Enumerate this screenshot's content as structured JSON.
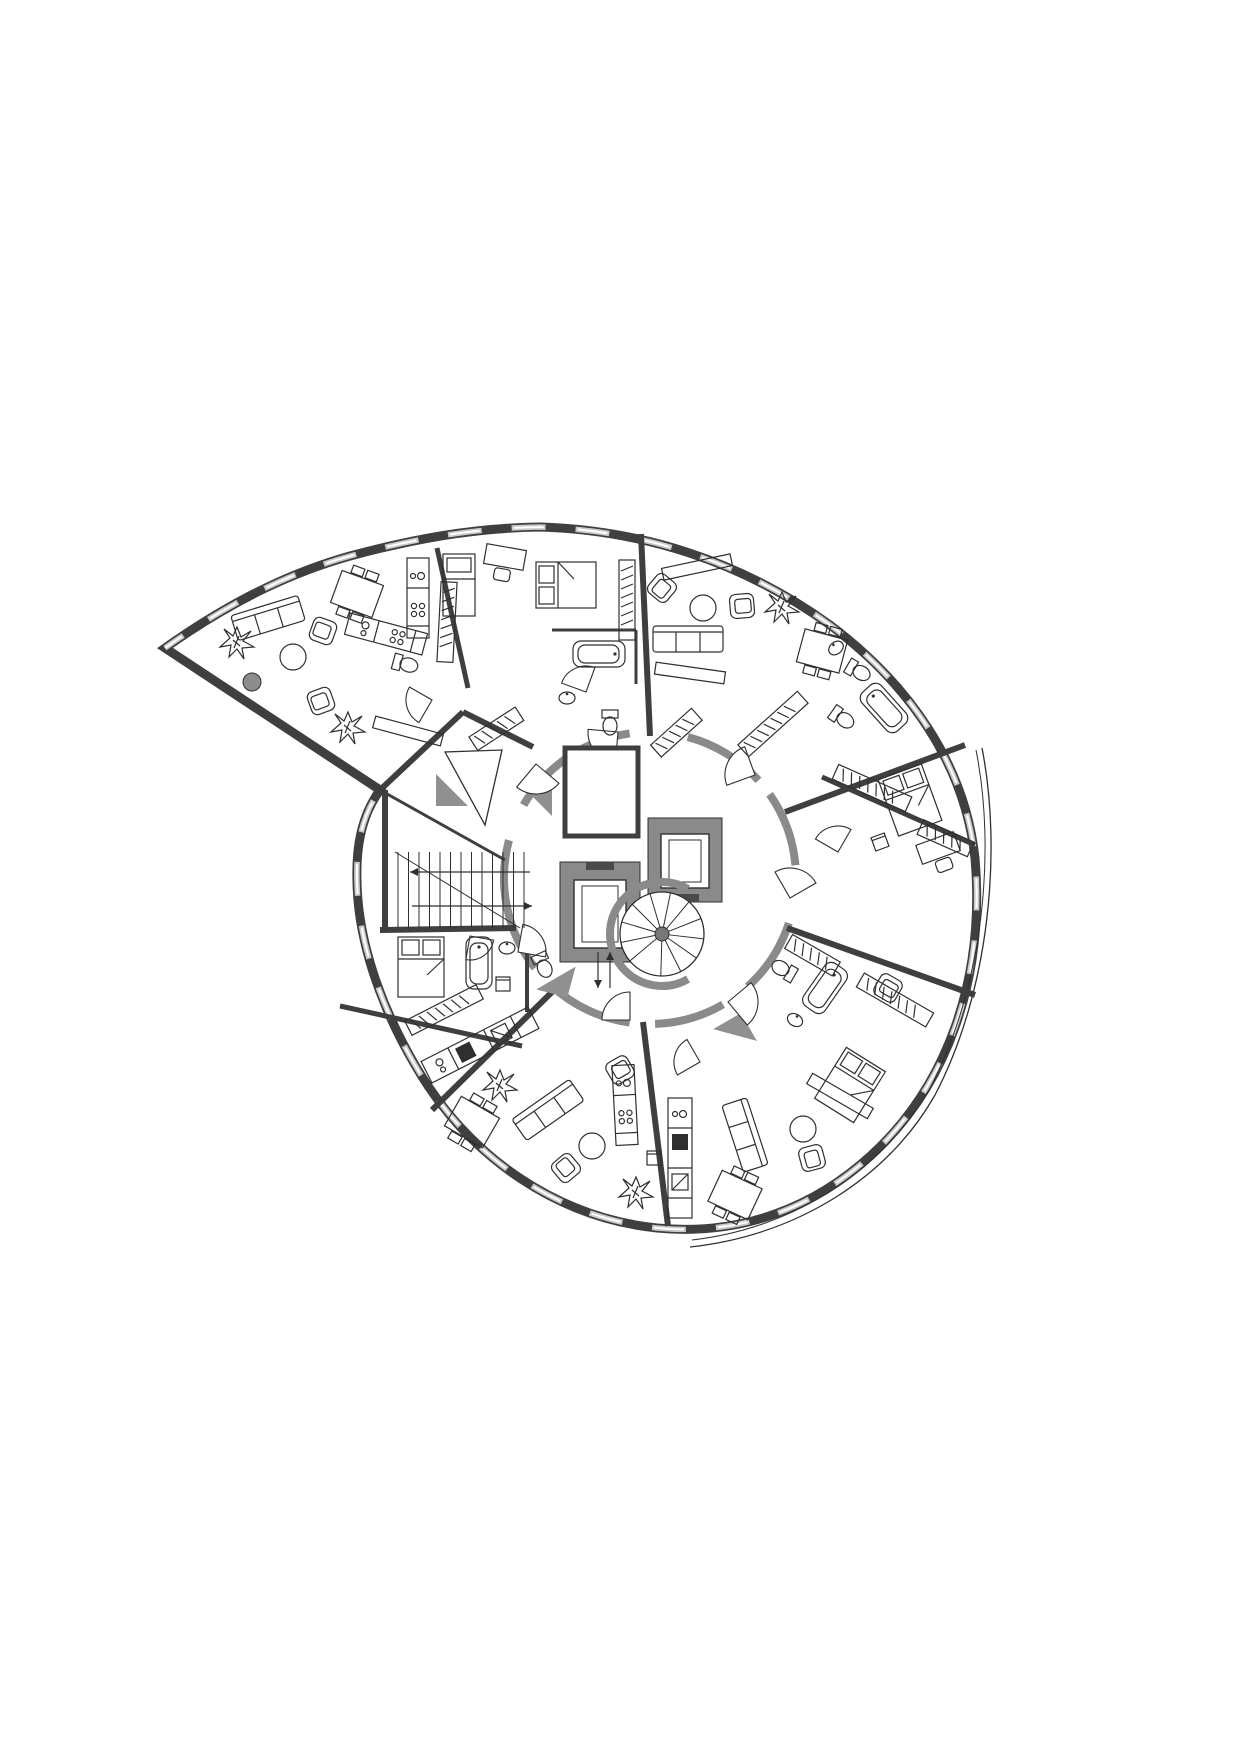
{
  "title_hidden": "",
  "colors": {
    "paper": "#ffffff",
    "ink": "#2f2f2f",
    "wall_dark": "#3f3f3f",
    "wall_hatch": "#8a8a8a",
    "window_light": "#c9c9c9",
    "shade_gray": "#909090",
    "column_gray": "#8d8d8d"
  },
  "plan": {
    "outline_d": "M 165,648 C 240,595 300,570 350,556 C 410,540 470,528 540,527 C 640,530 740,560 830,625 C 910,685 965,765 975,858 C 985,975 950,1090 860,1165 C 800,1215 730,1235 657,1228 C 560,1218 470,1160 415,1065 C 380,1005 358,940 357,882 C 356,850 360,818 380,790 L 165,648 Z",
    "window_d": "M 165,648 C 240,595 300,570 350,556 C 410,540 470,528 540,527 C 640,530 740,560 830,625 C 910,685 965,765 975,858 C 985,975 950,1090 860,1165 C 800,1215 730,1235 657,1228 C 560,1218 470,1160 415,1065 C 380,1005 358,940 357,882 C 356,850 360,818 380,790",
    "balcony_d1": "M 982,748 C 1002,850 990,990 935,1095 C 890,1175 800,1235 690,1247",
    "balcony_d2": "M 976,750 C 996,850 984,985 930,1088 C 886,1166 798,1228 692,1240",
    "hall": {
      "cx": 650,
      "cy": 878,
      "r": 146,
      "segments": [
        [
          285,
          318
        ],
        [
          325,
          355
        ],
        [
          18,
          48
        ],
        [
          60,
          88
        ],
        [
          98,
          132
        ],
        [
          142,
          195
        ],
        [
          210,
          262
        ]
      ]
    },
    "radial_walls": [
      [
        437,
        548,
        468,
        688,
        5
      ],
      [
        641,
        534,
        650,
        736,
        6
      ],
      [
        785,
        812,
        965,
        745,
        6
      ],
      [
        787,
        928,
        975,
        995,
        6
      ],
      [
        643,
        1022,
        668,
        1226,
        6
      ],
      [
        552,
        992,
        432,
        1110,
        6
      ]
    ],
    "stub_walls": [
      [
        552,
        630,
        636,
        630,
        3
      ],
      [
        636,
        630,
        636,
        684,
        3
      ],
      [
        822,
        777,
        975,
        845,
        5
      ],
      [
        380,
        930,
        516,
        928,
        6
      ],
      [
        340,
        1006,
        522,
        1046,
        5
      ],
      [
        380,
        790,
        505,
        860,
        3
      ],
      [
        380,
        790,
        463,
        712,
        6
      ],
      [
        463,
        712,
        533,
        747,
        6
      ],
      [
        527,
        935,
        527,
        1012,
        4
      ],
      [
        385,
        790,
        385,
        930,
        6
      ]
    ]
  },
  "core": {
    "elevator_a": {
      "outer": [
        560,
        862,
        80,
        100
      ],
      "cab": [
        574,
        880,
        52,
        68
      ],
      "door": [
        586,
        862,
        28,
        8
      ]
    },
    "elevator_b": {
      "outer": [
        648,
        818,
        74,
        84
      ],
      "cab": [
        661,
        834,
        48,
        54
      ],
      "door": [
        671,
        894,
        28,
        8
      ]
    },
    "duct_room": {
      "rect": [
        565,
        748,
        73,
        88
      ]
    },
    "spiral_stair": {
      "cx": 662,
      "cy": 934,
      "r": 42,
      "pole": 7,
      "treads": 12,
      "wall_arc": [
        60,
        300
      ],
      "wall_r": 52
    },
    "straight_stair": {
      "x0": 398,
      "y0": 852,
      "y1": 928,
      "n": 13,
      "dx": 10.5,
      "diag": [
        395,
        852,
        520,
        928
      ],
      "arrow1": [
        530,
        872,
        410,
        872
      ],
      "arrow2": [
        412,
        906,
        532,
        906
      ]
    },
    "hall_arrows": [
      [
        598,
        952,
        598,
        988
      ],
      [
        610,
        988,
        610,
        952
      ]
    ]
  },
  "entrance": {
    "ramp_triangle": [
      [
        445,
        752
      ],
      [
        485,
        825
      ],
      [
        502,
        750
      ]
    ],
    "gray_triangles": [
      [
        586,
        770,
        0
      ],
      [
        615,
        812,
        180
      ],
      [
        556,
        978,
        15
      ],
      [
        735,
        1035,
        -120
      ],
      [
        452,
        790,
        90
      ],
      [
        536,
        800,
        -90
      ]
    ]
  },
  "doors": [
    [
      618,
      732,
      30,
      95
    ],
    [
      755,
      775,
      30,
      160
    ],
    [
      790,
      898,
      30,
      -120
    ],
    [
      728,
      1002,
      30,
      -40
    ],
    [
      630,
      1020,
      28,
      180
    ],
    [
      518,
      952,
      28,
      -80
    ],
    [
      536,
      764,
      30,
      40
    ],
    [
      586,
      692,
      26,
      200
    ],
    [
      700,
      1062,
      26,
      150
    ],
    [
      470,
      936,
      24,
      10
    ],
    [
      432,
      700,
      26,
      120
    ],
    [
      838,
      852,
      26,
      -150
    ]
  ],
  "furniture": [
    [
      "plant",
      237,
      642,
      0
    ],
    [
      "plant",
      348,
      727,
      0
    ],
    [
      "plant",
      782,
      607,
      0
    ],
    [
      "plant",
      636,
      1192,
      0
    ],
    [
      "plant",
      500,
      1085,
      0
    ],
    [
      "sofa",
      268,
      618,
      -17
    ],
    [
      "armch",
      323,
      631,
      110
    ],
    [
      "armch",
      321,
      701,
      70
    ],
    [
      "tbl_r",
      293,
      657,
      0
    ],
    [
      "col",
      252,
      682,
      0
    ],
    [
      "dining",
      357,
      594,
      20
    ],
    [
      "k80",
      418,
      598,
      90
    ],
    [
      "k80",
      386,
      634,
      15
    ],
    [
      "wc",
      405,
      664,
      -75
    ],
    [
      "wrd80",
      447,
      622,
      93
    ],
    [
      "side",
      408,
      731,
      15
    ],
    [
      "wrd55",
      496,
      729,
      -33
    ],
    [
      "bed_s",
      459,
      585,
      0
    ],
    [
      "desk",
      505,
      557,
      10
    ],
    [
      "bed_d",
      566,
      585,
      0
    ],
    [
      "wrd80",
      627,
      600,
      90
    ],
    [
      "tub",
      599,
      654,
      90
    ],
    [
      "sink",
      567,
      698,
      0
    ],
    [
      "wc",
      610,
      722,
      0
    ],
    [
      "armch",
      662,
      588,
      40
    ],
    [
      "side",
      697,
      567,
      -12
    ],
    [
      "tbl_r",
      703,
      608,
      0
    ],
    [
      "armch",
      742,
      606,
      -95
    ],
    [
      "sofa",
      688,
      639,
      0
    ],
    [
      "side",
      690,
      673,
      8
    ],
    [
      "dining",
      822,
      651,
      15
    ],
    [
      "wc",
      858,
      671,
      -60
    ],
    [
      "tub",
      884,
      708,
      -42
    ],
    [
      "wrd80",
      773,
      724,
      -42
    ],
    [
      "wrd55",
      676,
      733,
      -42
    ],
    [
      "sink",
      836,
      648,
      -40
    ],
    [
      "bed_d",
      910,
      800,
      70
    ],
    [
      "chair",
      880,
      842,
      -20
    ],
    [
      "desk",
      938,
      848,
      -20
    ],
    [
      "wrd80",
      872,
      788,
      24
    ],
    [
      "wrd55",
      945,
      838,
      24
    ],
    [
      "wc",
      842,
      718,
      -55
    ],
    [
      "bed_d",
      850,
      1085,
      122
    ],
    [
      "wrd80",
      895,
      1000,
      30
    ],
    [
      "wrd55",
      812,
      955,
      30
    ],
    [
      "tub",
      825,
      988,
      35
    ],
    [
      "wc",
      784,
      970,
      120
    ],
    [
      "sink",
      795,
      1020,
      30
    ],
    [
      "k120",
      680,
      1158,
      90
    ],
    [
      "dining",
      735,
      1195,
      25
    ],
    [
      "sofa",
      745,
      1135,
      72
    ],
    [
      "tbl_r",
      803,
      1129,
      0
    ],
    [
      "armch",
      812,
      1158,
      -15
    ],
    [
      "armch",
      888,
      988,
      -60
    ],
    [
      "side",
      840,
      1096,
      30
    ],
    [
      "dining",
      472,
      1122,
      30
    ],
    [
      "sofa",
      548,
      1110,
      -35
    ],
    [
      "tbl_r",
      592,
      1146,
      0
    ],
    [
      "armch",
      566,
      1168,
      140
    ],
    [
      "armch",
      620,
      1070,
      -120
    ],
    [
      "chair",
      654,
      1158,
      0
    ],
    [
      "k120",
      480,
      1045,
      -27
    ],
    [
      "wrd80",
      444,
      1010,
      -27
    ],
    [
      "k80",
      625,
      1105,
      87
    ],
    [
      "bed_d",
      421,
      967,
      90
    ],
    [
      "tub",
      479,
      963,
      0
    ],
    [
      "sink",
      507,
      948,
      0
    ],
    [
      "wc",
      543,
      965,
      -25
    ],
    [
      "chair",
      503,
      984,
      0
    ]
  ],
  "symbol_names": {
    "bed_d": "double-bed",
    "bed_s": "single-bed",
    "sofa": "sofa",
    "armch": "armchair",
    "chair": "chair",
    "tbl_r": "round-table",
    "dining": "dining-table",
    "tub": "bathtub",
    "wc": "toilet",
    "sink": "sink",
    "k80": "kitchen-counter",
    "k120": "kitchen-counter-long",
    "wrd80": "wardrobe",
    "wrd55": "wardrobe-short",
    "plant": "potted-plant",
    "desk": "desk",
    "col": "round-column",
    "side": "sideboard"
  }
}
